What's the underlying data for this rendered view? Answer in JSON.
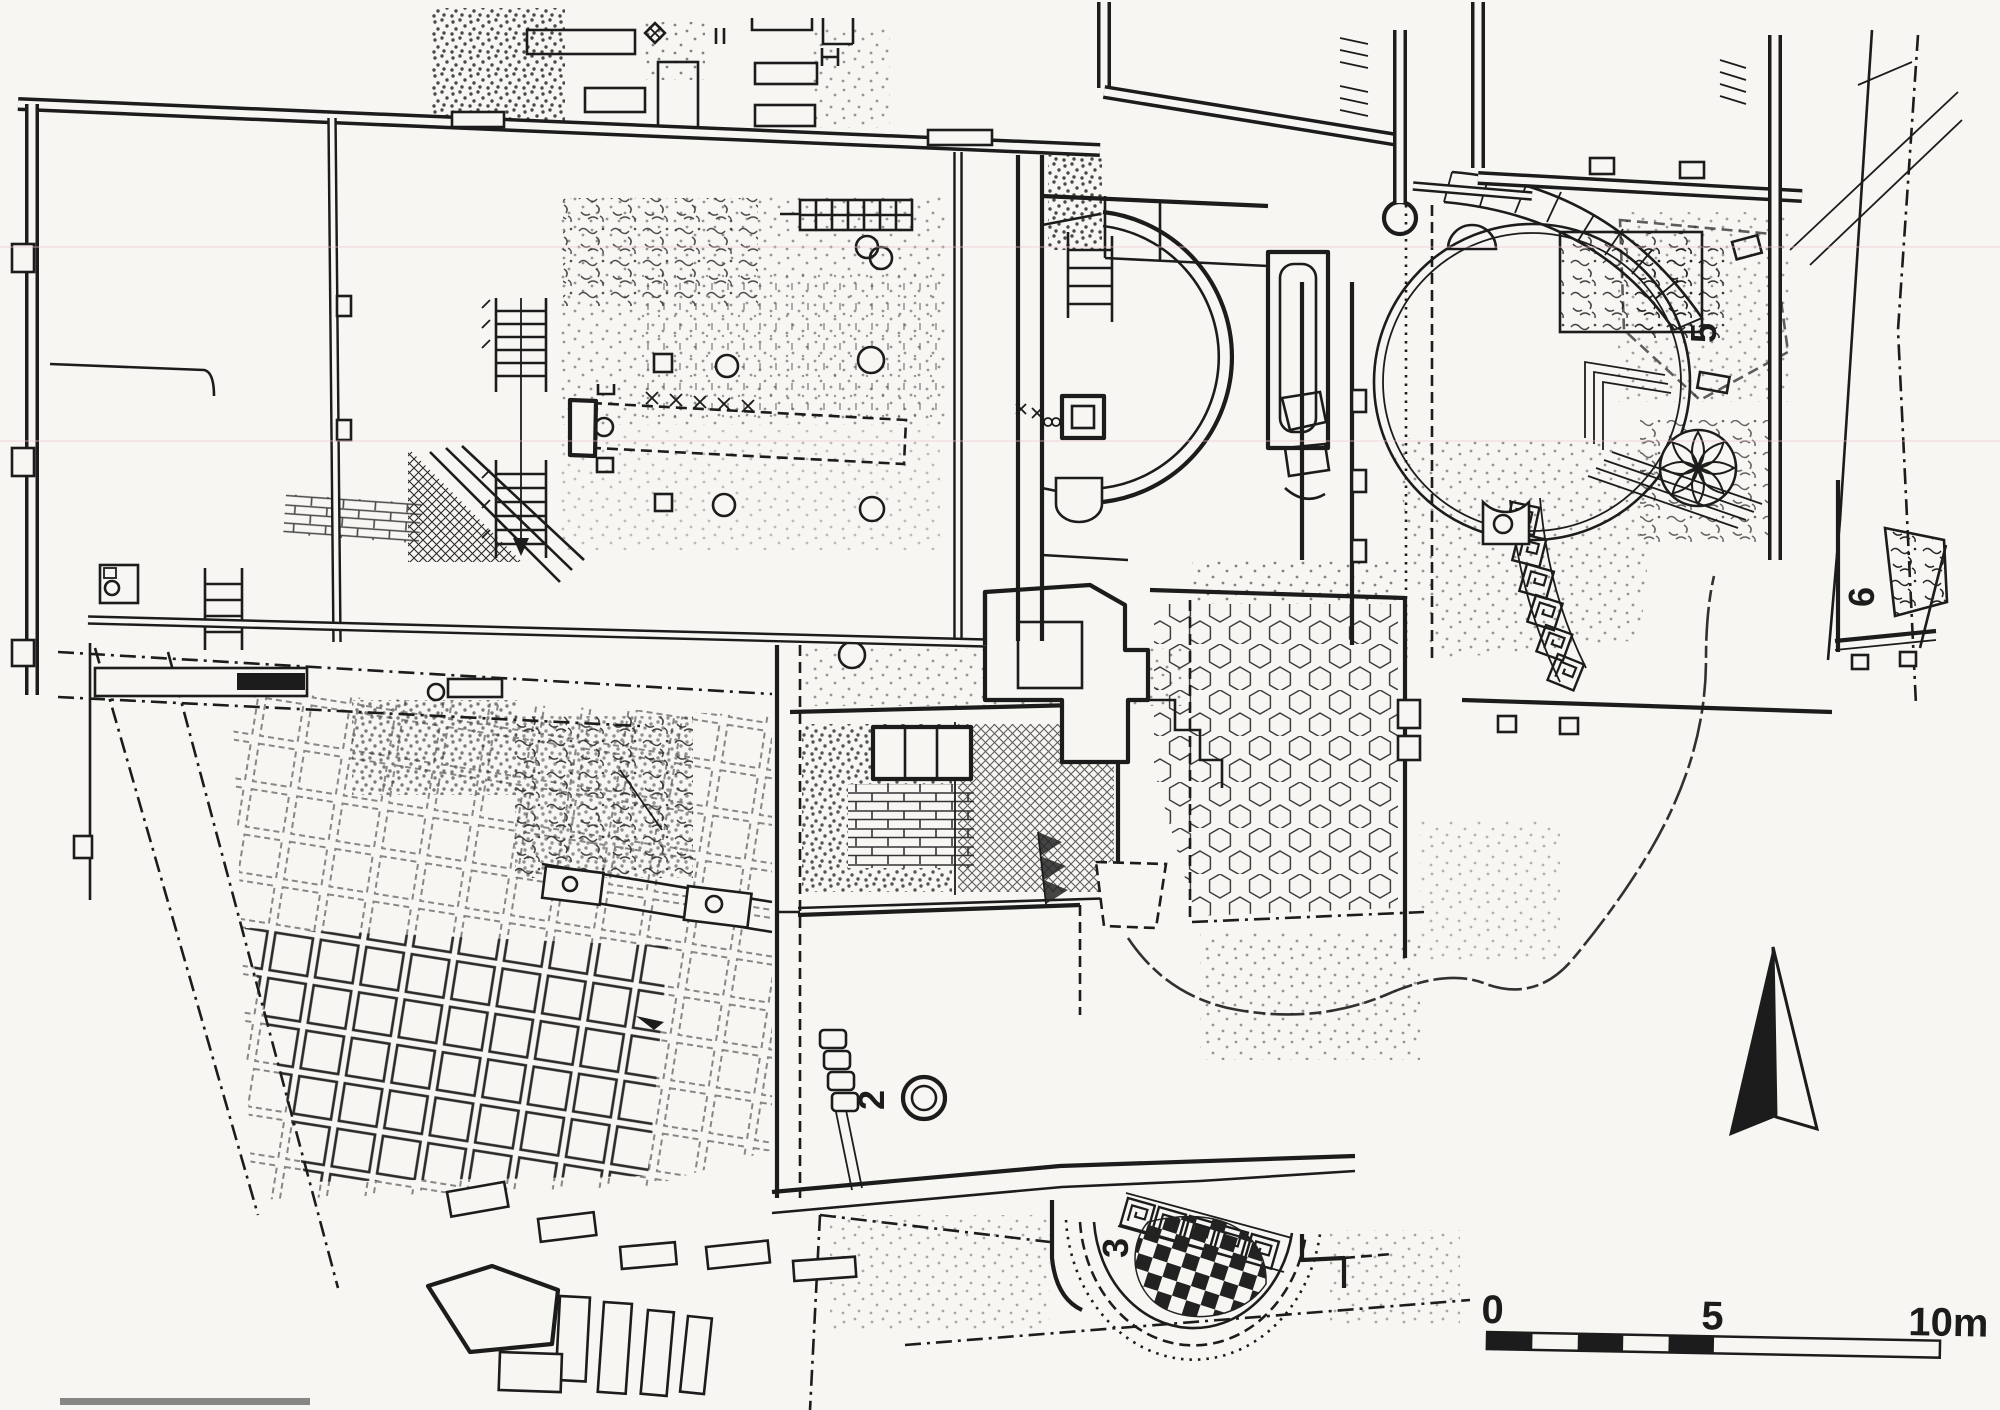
{
  "document": {
    "kind": "archaeological excavation plan",
    "medium": "scanned black-ink line drawing on paper"
  },
  "colors": {
    "paper": "#f7f6f2",
    "ink": "#1c1c1c"
  },
  "area_labels": [
    {
      "id": "area-2",
      "text": "2"
    },
    {
      "id": "area-3",
      "text": "3"
    },
    {
      "id": "area-5",
      "text": "5"
    },
    {
      "id": "area-6",
      "text": "6"
    }
  ],
  "scale_bar": {
    "ticks": [
      "0",
      "5",
      "10m"
    ],
    "unit": "m",
    "half_segments": 5
  },
  "compass": {
    "type": "half-filled north arrow"
  },
  "pattern_legend": [
    "slab-pavement",
    "faint-slab-pavement",
    "checkerboard-mosaic",
    "honeycomb-mosaic",
    "crosshatch-mosaic",
    "greek-key-border",
    "stipple-floor",
    "rubble",
    "brickwork"
  ]
}
